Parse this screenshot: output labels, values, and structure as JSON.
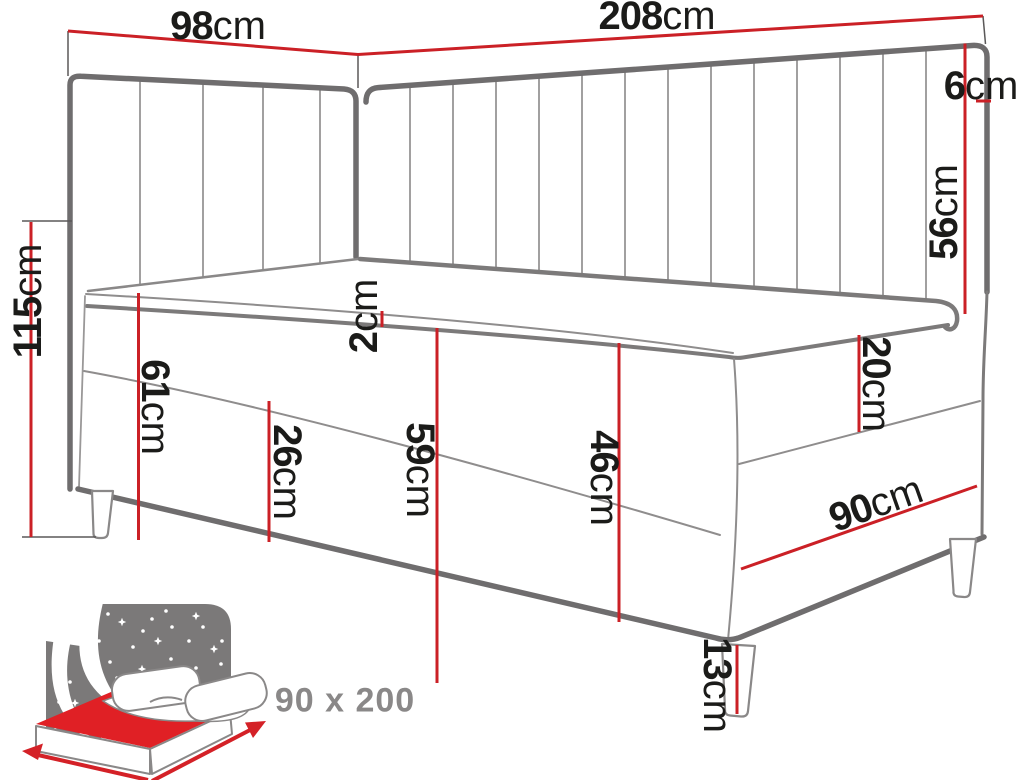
{
  "diagram": {
    "type": "furniture-dimension-diagram",
    "subject": "corner-boxspring-bed-line-drawing",
    "units": "cm",
    "dimensions": {
      "d98": {
        "value": "98",
        "unit": "cm"
      },
      "d208": {
        "value": "208",
        "unit": "cm"
      },
      "d6": {
        "value": "6",
        "unit": "cm"
      },
      "d56": {
        "value": "56",
        "unit": "cm"
      },
      "d115": {
        "value": "115",
        "unit": "cm"
      },
      "d2": {
        "value": "2",
        "unit": "cm"
      },
      "d61": {
        "value": "61",
        "unit": "cm"
      },
      "d26": {
        "value": "26",
        "unit": "cm"
      },
      "d59": {
        "value": "59",
        "unit": "cm"
      },
      "d46": {
        "value": "46",
        "unit": "cm"
      },
      "d20": {
        "value": "20",
        "unit": "cm"
      },
      "d13": {
        "value": "13",
        "unit": "cm"
      },
      "d90": {
        "value": "90",
        "unit": "cm"
      }
    },
    "caption": {
      "bed_size": "90 x 200"
    },
    "colors": {
      "dimension_line_red": "#cb2026",
      "outline_dark_gray": "#6f6d6e",
      "outline_mid_gray": "#8a8888",
      "outline_light_gray": "#9a9898",
      "label_text_black": "#1b1b19",
      "icon_panel_gray": "#7b7979",
      "icon_mattress_red": "#e02025",
      "caption_gray": "#8a8888",
      "background": "#ffffff"
    }
  }
}
